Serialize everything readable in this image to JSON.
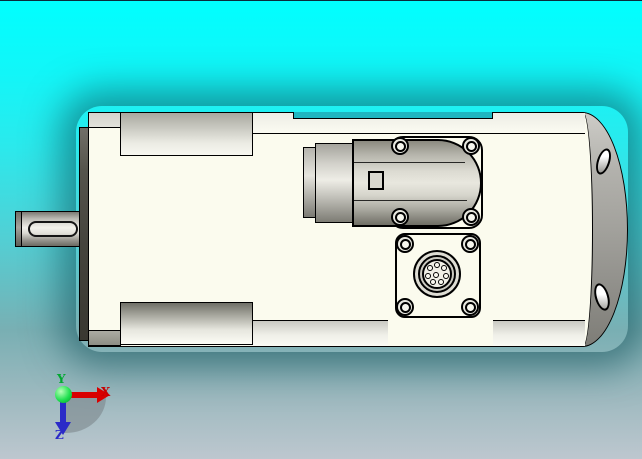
{
  "scene": {
    "description": "3D CAD preview of a servo motor (side view) with shaft, keyway, top plug connector and round multi-pin connector",
    "background": {
      "top": "#00FFFF",
      "mid": "#5FC9CC",
      "bottom": "#BDC7CF"
    },
    "model": {
      "body_color": "#FBFBEE",
      "endcap_color": "#9B9A95",
      "outline_color": "#000000"
    }
  },
  "triad": {
    "x": {
      "label": "X",
      "color": "#C80000"
    },
    "y": {
      "label": "Y",
      "color": "#00A830"
    },
    "z": {
      "label": "Z",
      "color": "#2B2BC8"
    }
  }
}
